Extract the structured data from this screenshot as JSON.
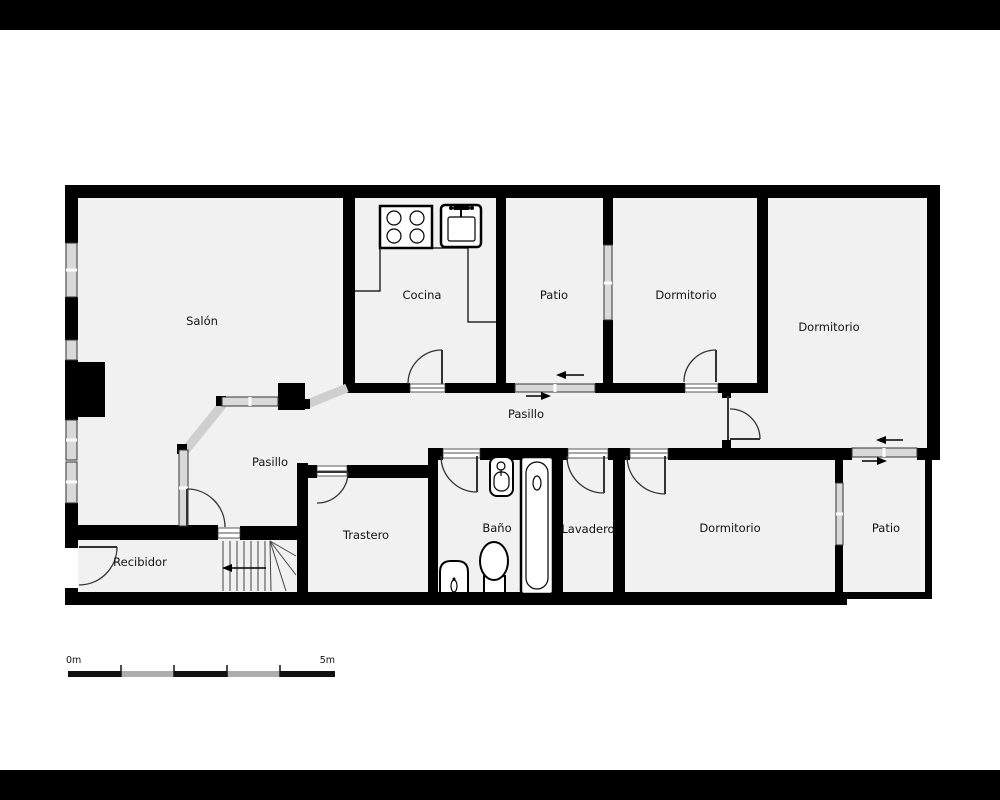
{
  "plan": {
    "title": "floor-plan",
    "rooms": [
      {
        "id": "salon",
        "label": "Salón"
      },
      {
        "id": "cocina",
        "label": "Cocina"
      },
      {
        "id": "patio-top",
        "label": "Patio"
      },
      {
        "id": "dormitorio-top-1",
        "label": "Dormitorio"
      },
      {
        "id": "dormitorio-top-2",
        "label": "Dormitorio"
      },
      {
        "id": "pasillo-upper",
        "label": "Pasillo"
      },
      {
        "id": "pasillo-lower",
        "label": "Pasillo"
      },
      {
        "id": "recibidor",
        "label": "Recibidor"
      },
      {
        "id": "trastero",
        "label": "Trastero"
      },
      {
        "id": "bano",
        "label": "Baño"
      },
      {
        "id": "lavadero",
        "label": "Lavadero"
      },
      {
        "id": "dormitorio-bottom",
        "label": "Dormitorio"
      },
      {
        "id": "patio-bottom",
        "label": "Patio"
      }
    ],
    "fixtures": [
      "stove-icon",
      "kitchen-sink-icon",
      "washbasin-icon",
      "bathtub-icon",
      "toilet-icon",
      "bidet-icon",
      "fireplace-icon",
      "stairs-icon",
      "entrance-arrows",
      "door-arcs",
      "windows"
    ],
    "scale_bar": {
      "start_label": "0m",
      "end_label": "5m"
    },
    "colors": {
      "wall": "#000000",
      "room_fill": "#f1f1f1",
      "glass_partition": "#cfcfcf",
      "window_pane": "#d9d9d9",
      "background": "#ffffff",
      "letterbox": "#000000"
    }
  }
}
